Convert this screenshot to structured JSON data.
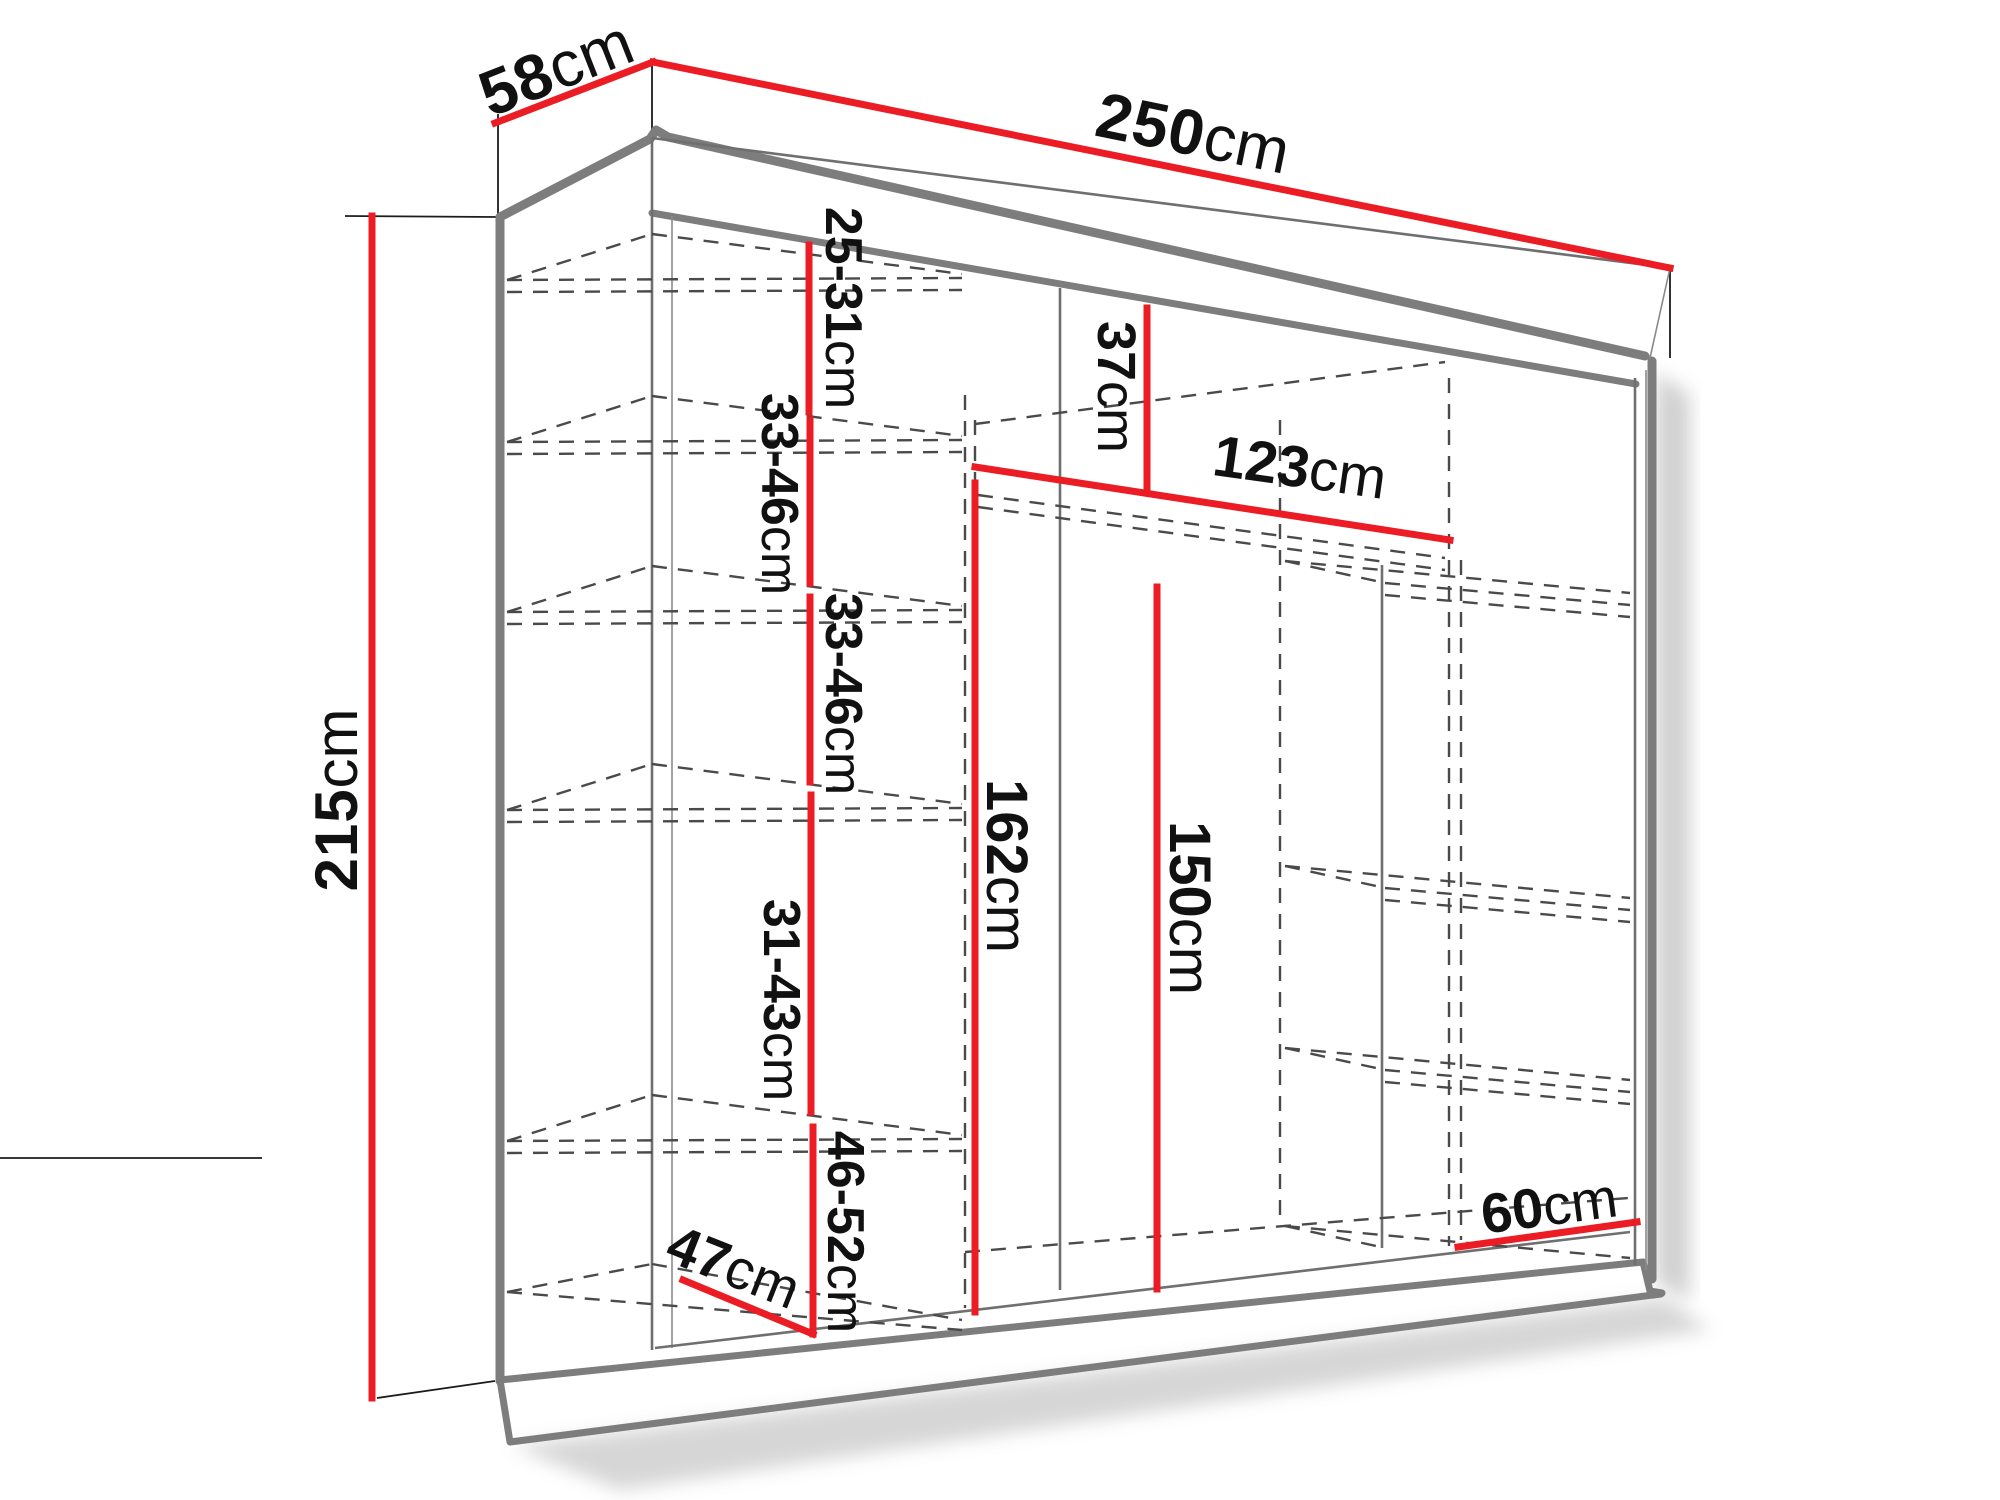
{
  "diagram": {
    "title": "wardrobe-dimension-diagram",
    "accent_color": "#ec1c24",
    "outline_color": "#7d7d7d",
    "unit": "cm",
    "dims": {
      "width": {
        "value": "250",
        "unit": "cm"
      },
      "depth": {
        "value": "58",
        "unit": "cm"
      },
      "height": {
        "value": "215",
        "unit": "cm"
      },
      "gap1": {
        "value": "25-31",
        "unit": "cm"
      },
      "gap2": {
        "value": "33-46",
        "unit": "cm"
      },
      "gap3": {
        "value": "33-46",
        "unit": "cm"
      },
      "gap4": {
        "value": "31-43",
        "unit": "cm"
      },
      "gap5": {
        "value": "46-52",
        "unit": "cm"
      },
      "top_gap": {
        "value": "37",
        "unit": "cm"
      },
      "rail_width": {
        "value": "123",
        "unit": "cm"
      },
      "rail_height": {
        "value": "162",
        "unit": "cm"
      },
      "right_height": {
        "value": "150",
        "unit": "cm"
      },
      "left_width": {
        "value": "47",
        "unit": "cm"
      },
      "right_width": {
        "value": "60",
        "unit": "cm"
      }
    }
  }
}
